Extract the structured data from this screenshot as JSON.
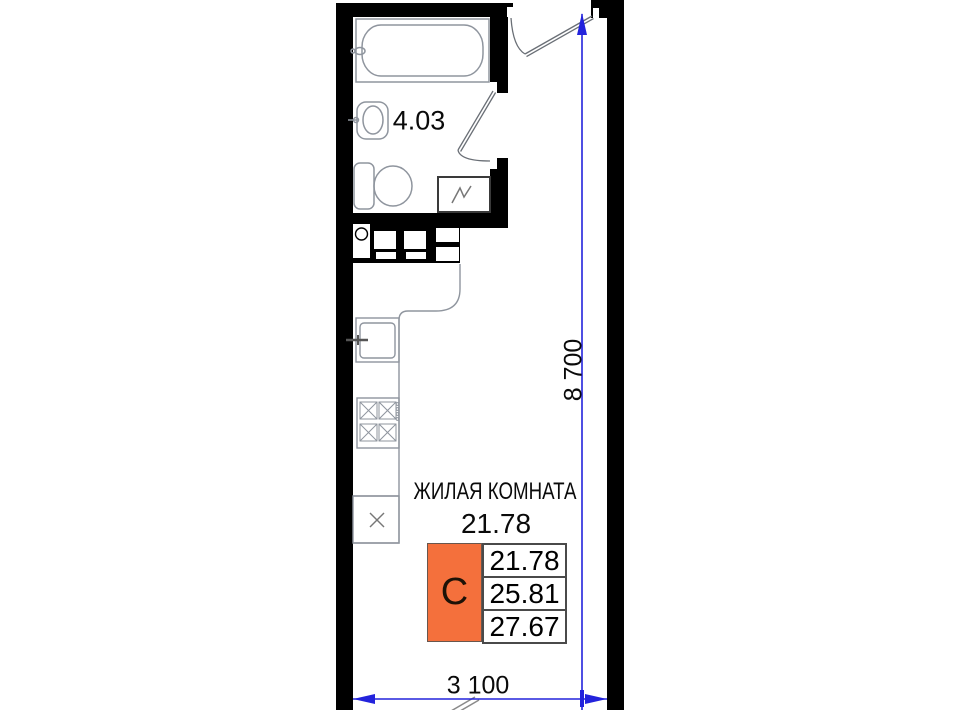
{
  "floor_plan": {
    "bathroom": {
      "area": "4.03"
    },
    "living_room": {
      "name": "ЖИЛАЯ КОМНАТА",
      "area": "21.78"
    },
    "legend": {
      "type_letter": "С",
      "values": [
        "21.78",
        "25.81",
        "27.67"
      ]
    },
    "dimensions": {
      "vertical": "8 700",
      "horizontal": "3 100"
    },
    "colors": {
      "accent_orange": "#f4703c",
      "dimension_blue": "#2323dc",
      "wall_black": "#000000",
      "fixture_gray": "#8f959e"
    }
  }
}
